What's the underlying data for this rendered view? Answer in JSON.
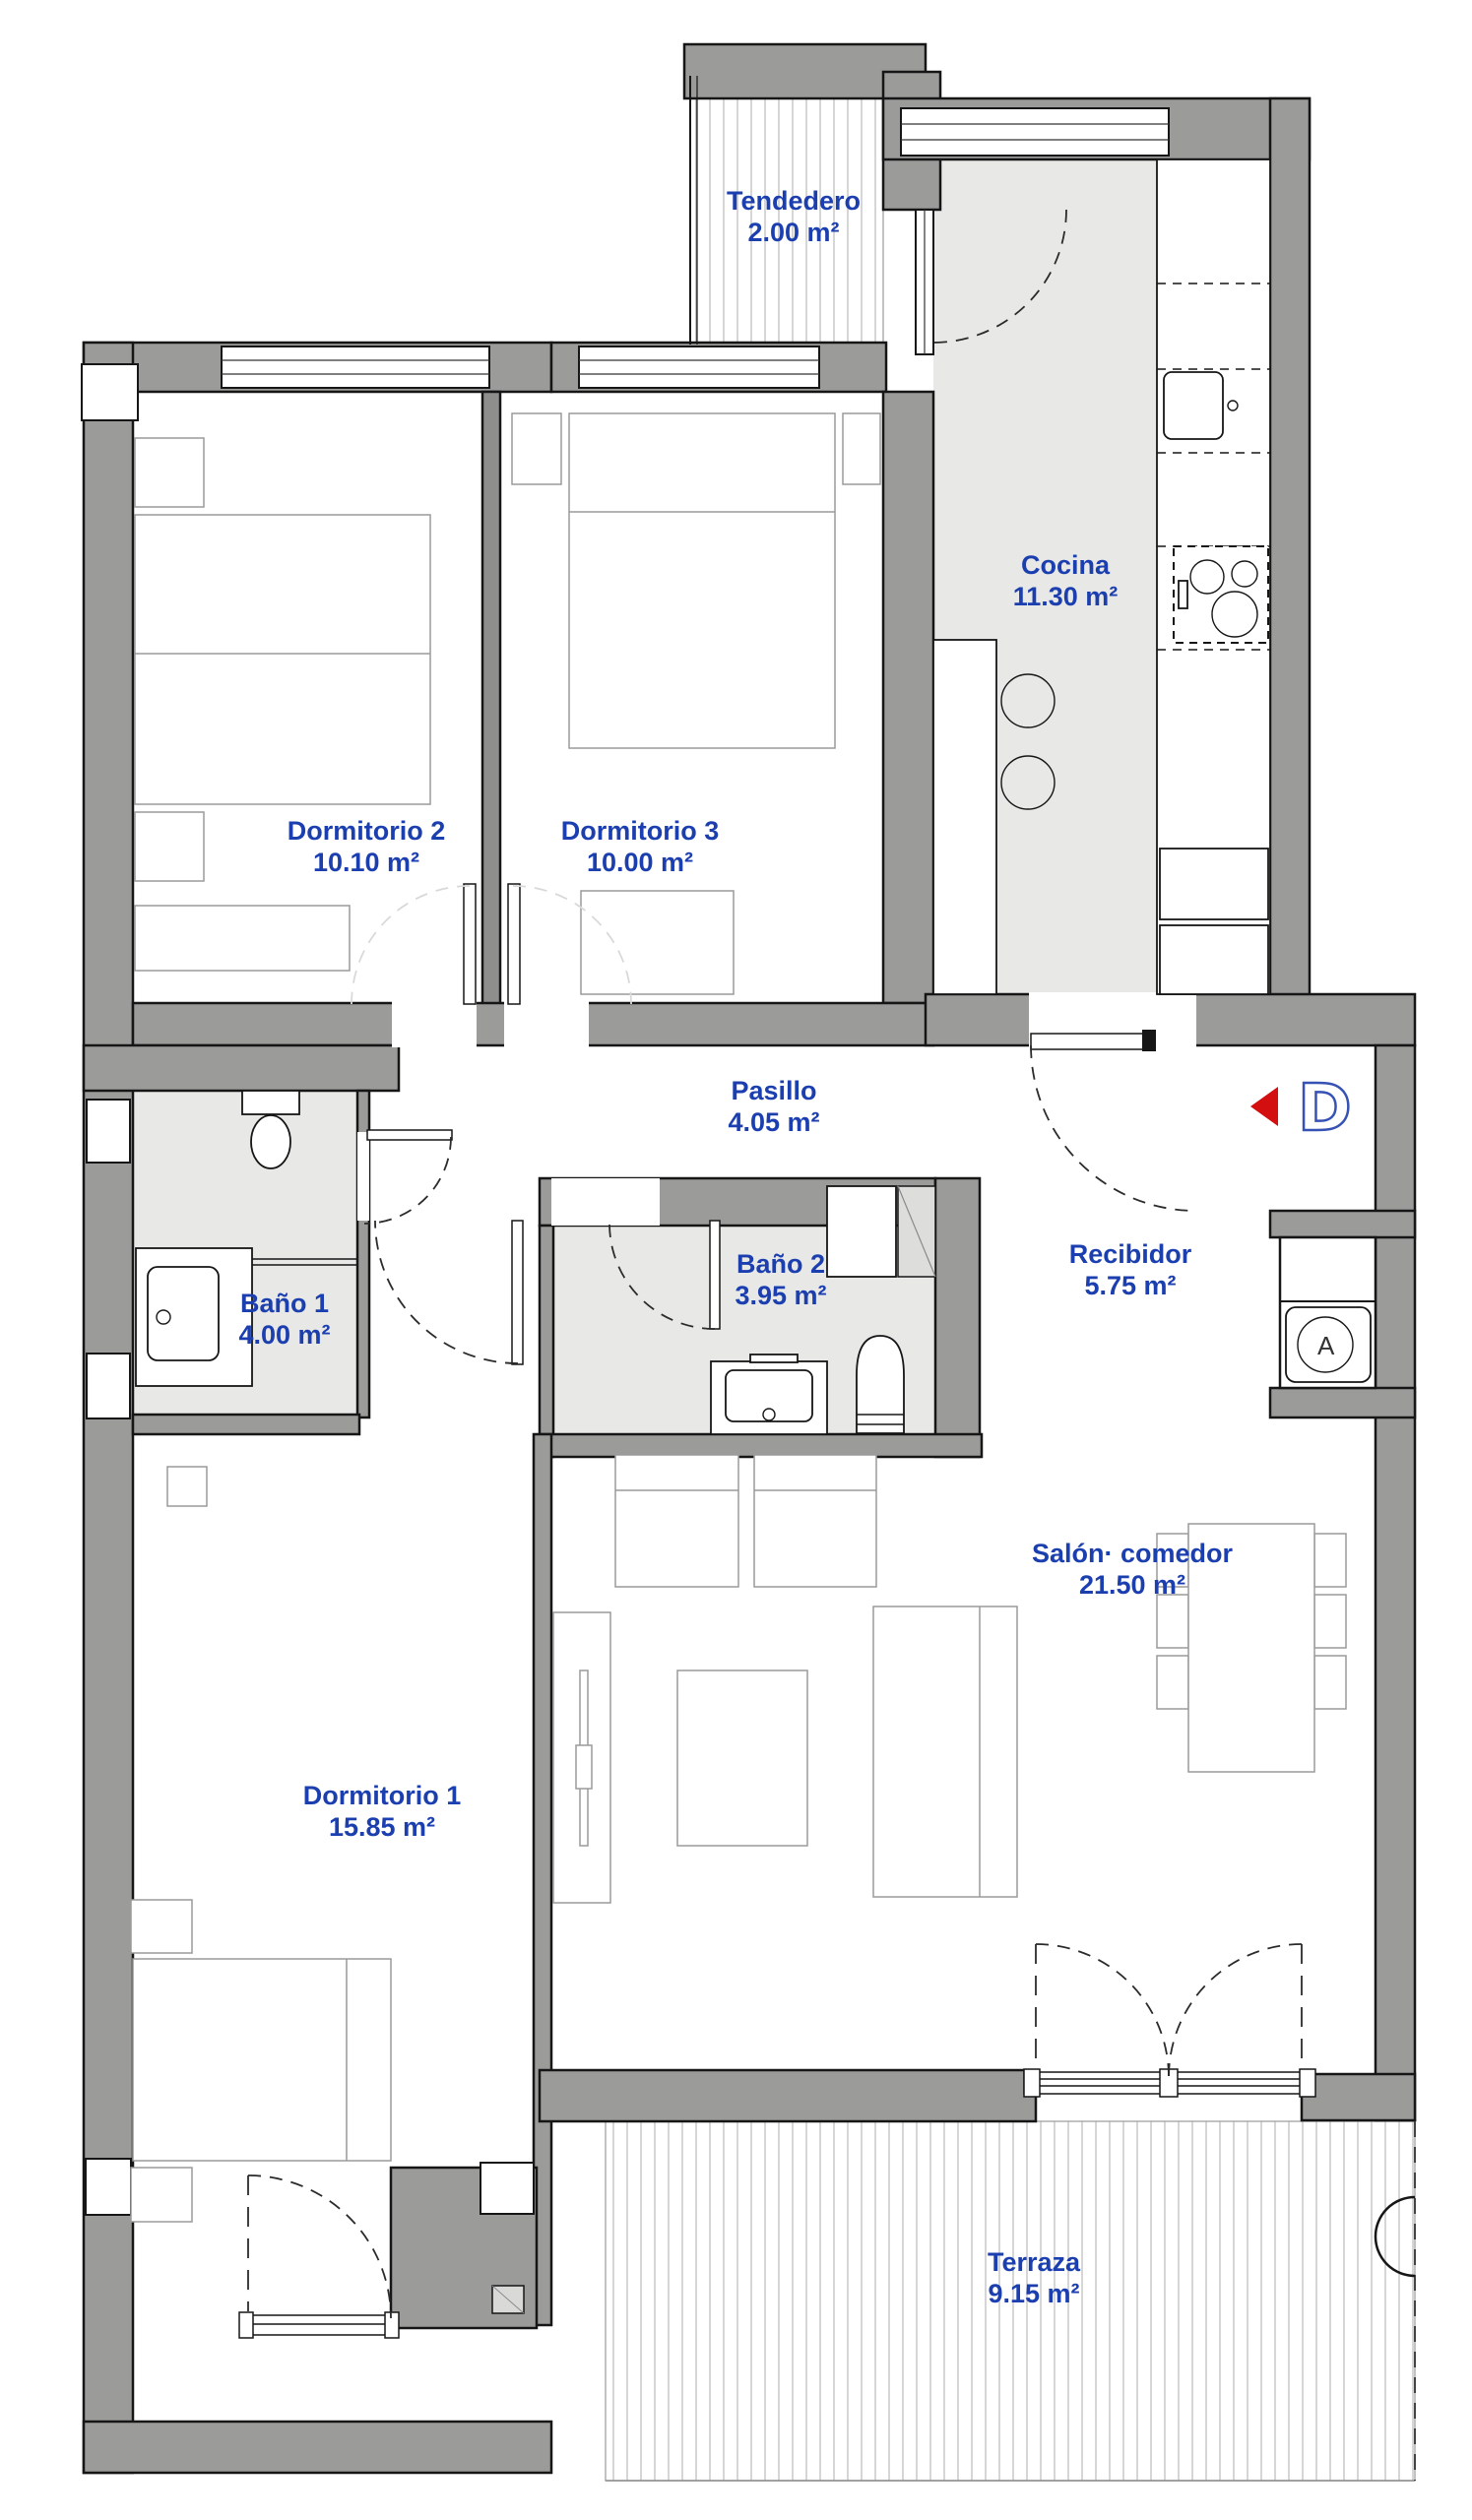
{
  "plan": {
    "rooms": [
      {
        "id": "tendedero",
        "name": "Tendedero",
        "area": "2.00 m²"
      },
      {
        "id": "cocina",
        "name": "Cocina",
        "area": "11.30 m²"
      },
      {
        "id": "dormitorio2",
        "name": "Dormitorio 2",
        "area": "10.10 m²"
      },
      {
        "id": "dormitorio3",
        "name": "Dormitorio 3",
        "area": "10.00 m²"
      },
      {
        "id": "pasillo",
        "name": "Pasillo",
        "area": "4.05 m²"
      },
      {
        "id": "bano1",
        "name": "Baño 1",
        "area": "4.00 m²"
      },
      {
        "id": "bano2",
        "name": "Baño 2",
        "area": "3.95 m²"
      },
      {
        "id": "recibidor",
        "name": "Recibidor",
        "area": "5.75 m²"
      },
      {
        "id": "salon",
        "name": "Salón· comedor",
        "area": "21.50 m²"
      },
      {
        "id": "dormitorio1",
        "name": "Dormitorio 1",
        "area": "15.85 m²"
      },
      {
        "id": "terraza",
        "name": "Terraza",
        "area": "9.15 m²"
      }
    ],
    "entrance_marker": {
      "letter": "D"
    },
    "appliance_marker": {
      "letter": "A"
    },
    "colors": {
      "label_blue": "#1c3fb0",
      "marker_blue": "#3752b5",
      "marker_red": "#d40f0f",
      "wall_gray": "#9b9b9a",
      "floor_gray": "#e8e8e7"
    }
  }
}
